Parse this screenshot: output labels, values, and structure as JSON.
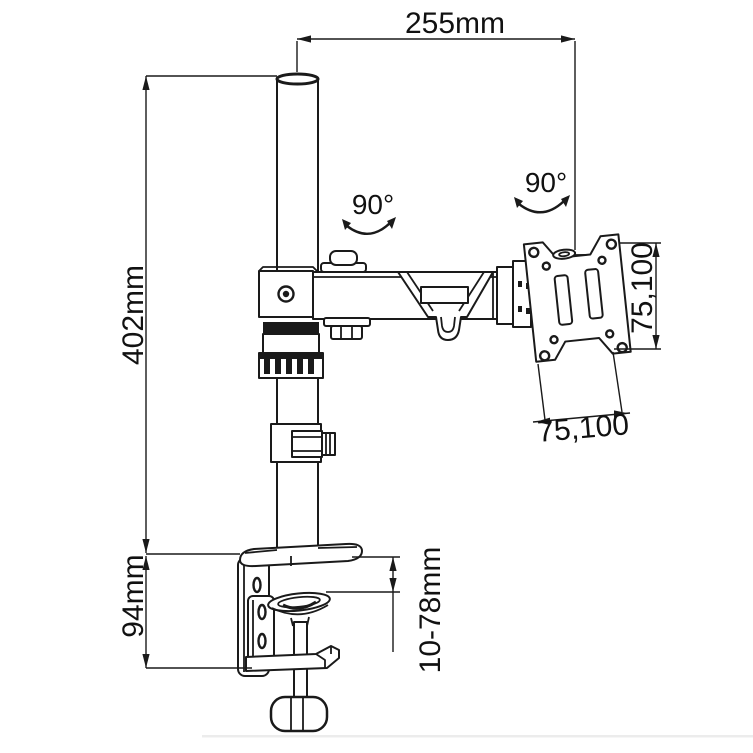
{
  "drawing": {
    "description": "Technical dimensional line drawing of a desk-clamp single monitor arm with VESA plate",
    "background": "#ffffff",
    "line_color": "#1a1a1a",
    "labels": {
      "arm_length": "255mm",
      "pole_height": "402mm",
      "clamp_body_height": "94mm",
      "desk_thickness_range": "10-78mm",
      "vesa_vertical": "75,100",
      "vesa_horizontal": "75,100",
      "arm_rotation": "90°",
      "vesa_rotation": "90°"
    }
  }
}
